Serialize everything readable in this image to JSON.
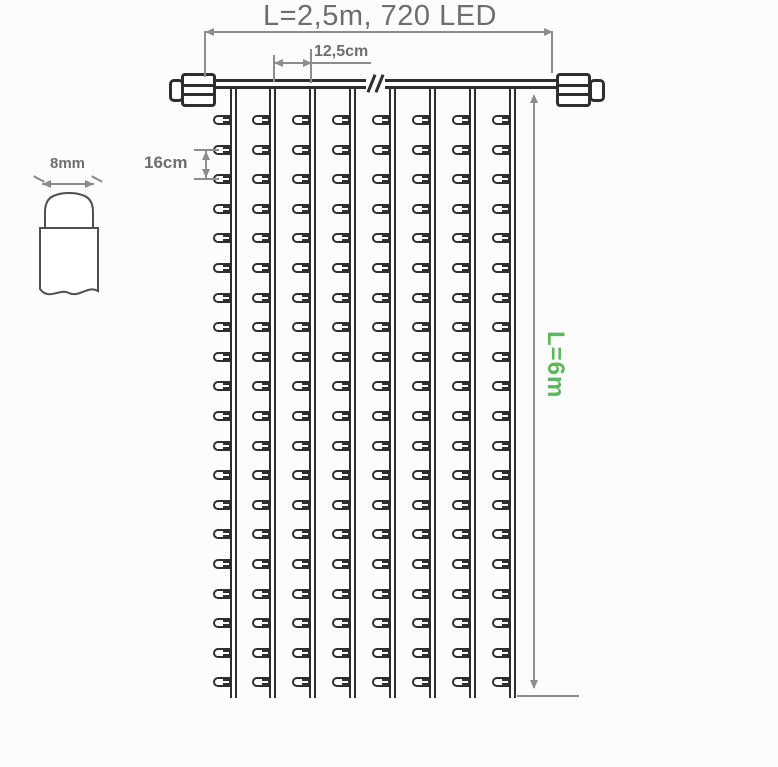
{
  "diagram": {
    "title": "L=2,5m, 720 LED",
    "strand_spacing_label": "12,5cm",
    "led_spacing_label": "16cm",
    "bulb_width_label": "8mm",
    "drop_length_label": "L=6m",
    "colors": {
      "line_dark": "#2e2e2e",
      "dim_gray": "#8d8d8d",
      "text_gray": "#6e6e6e",
      "accent_green": "#5cb85c",
      "background": "#fcfcfc"
    },
    "curtain": {
      "strands": 8,
      "leds_per_strand": 20,
      "strand_x_start": 233,
      "strand_x_step": 39.9,
      "strand_top_y": 86,
      "strand_bottom_y": 698,
      "led_y_start": 120,
      "led_y_step": 29.6
    }
  }
}
